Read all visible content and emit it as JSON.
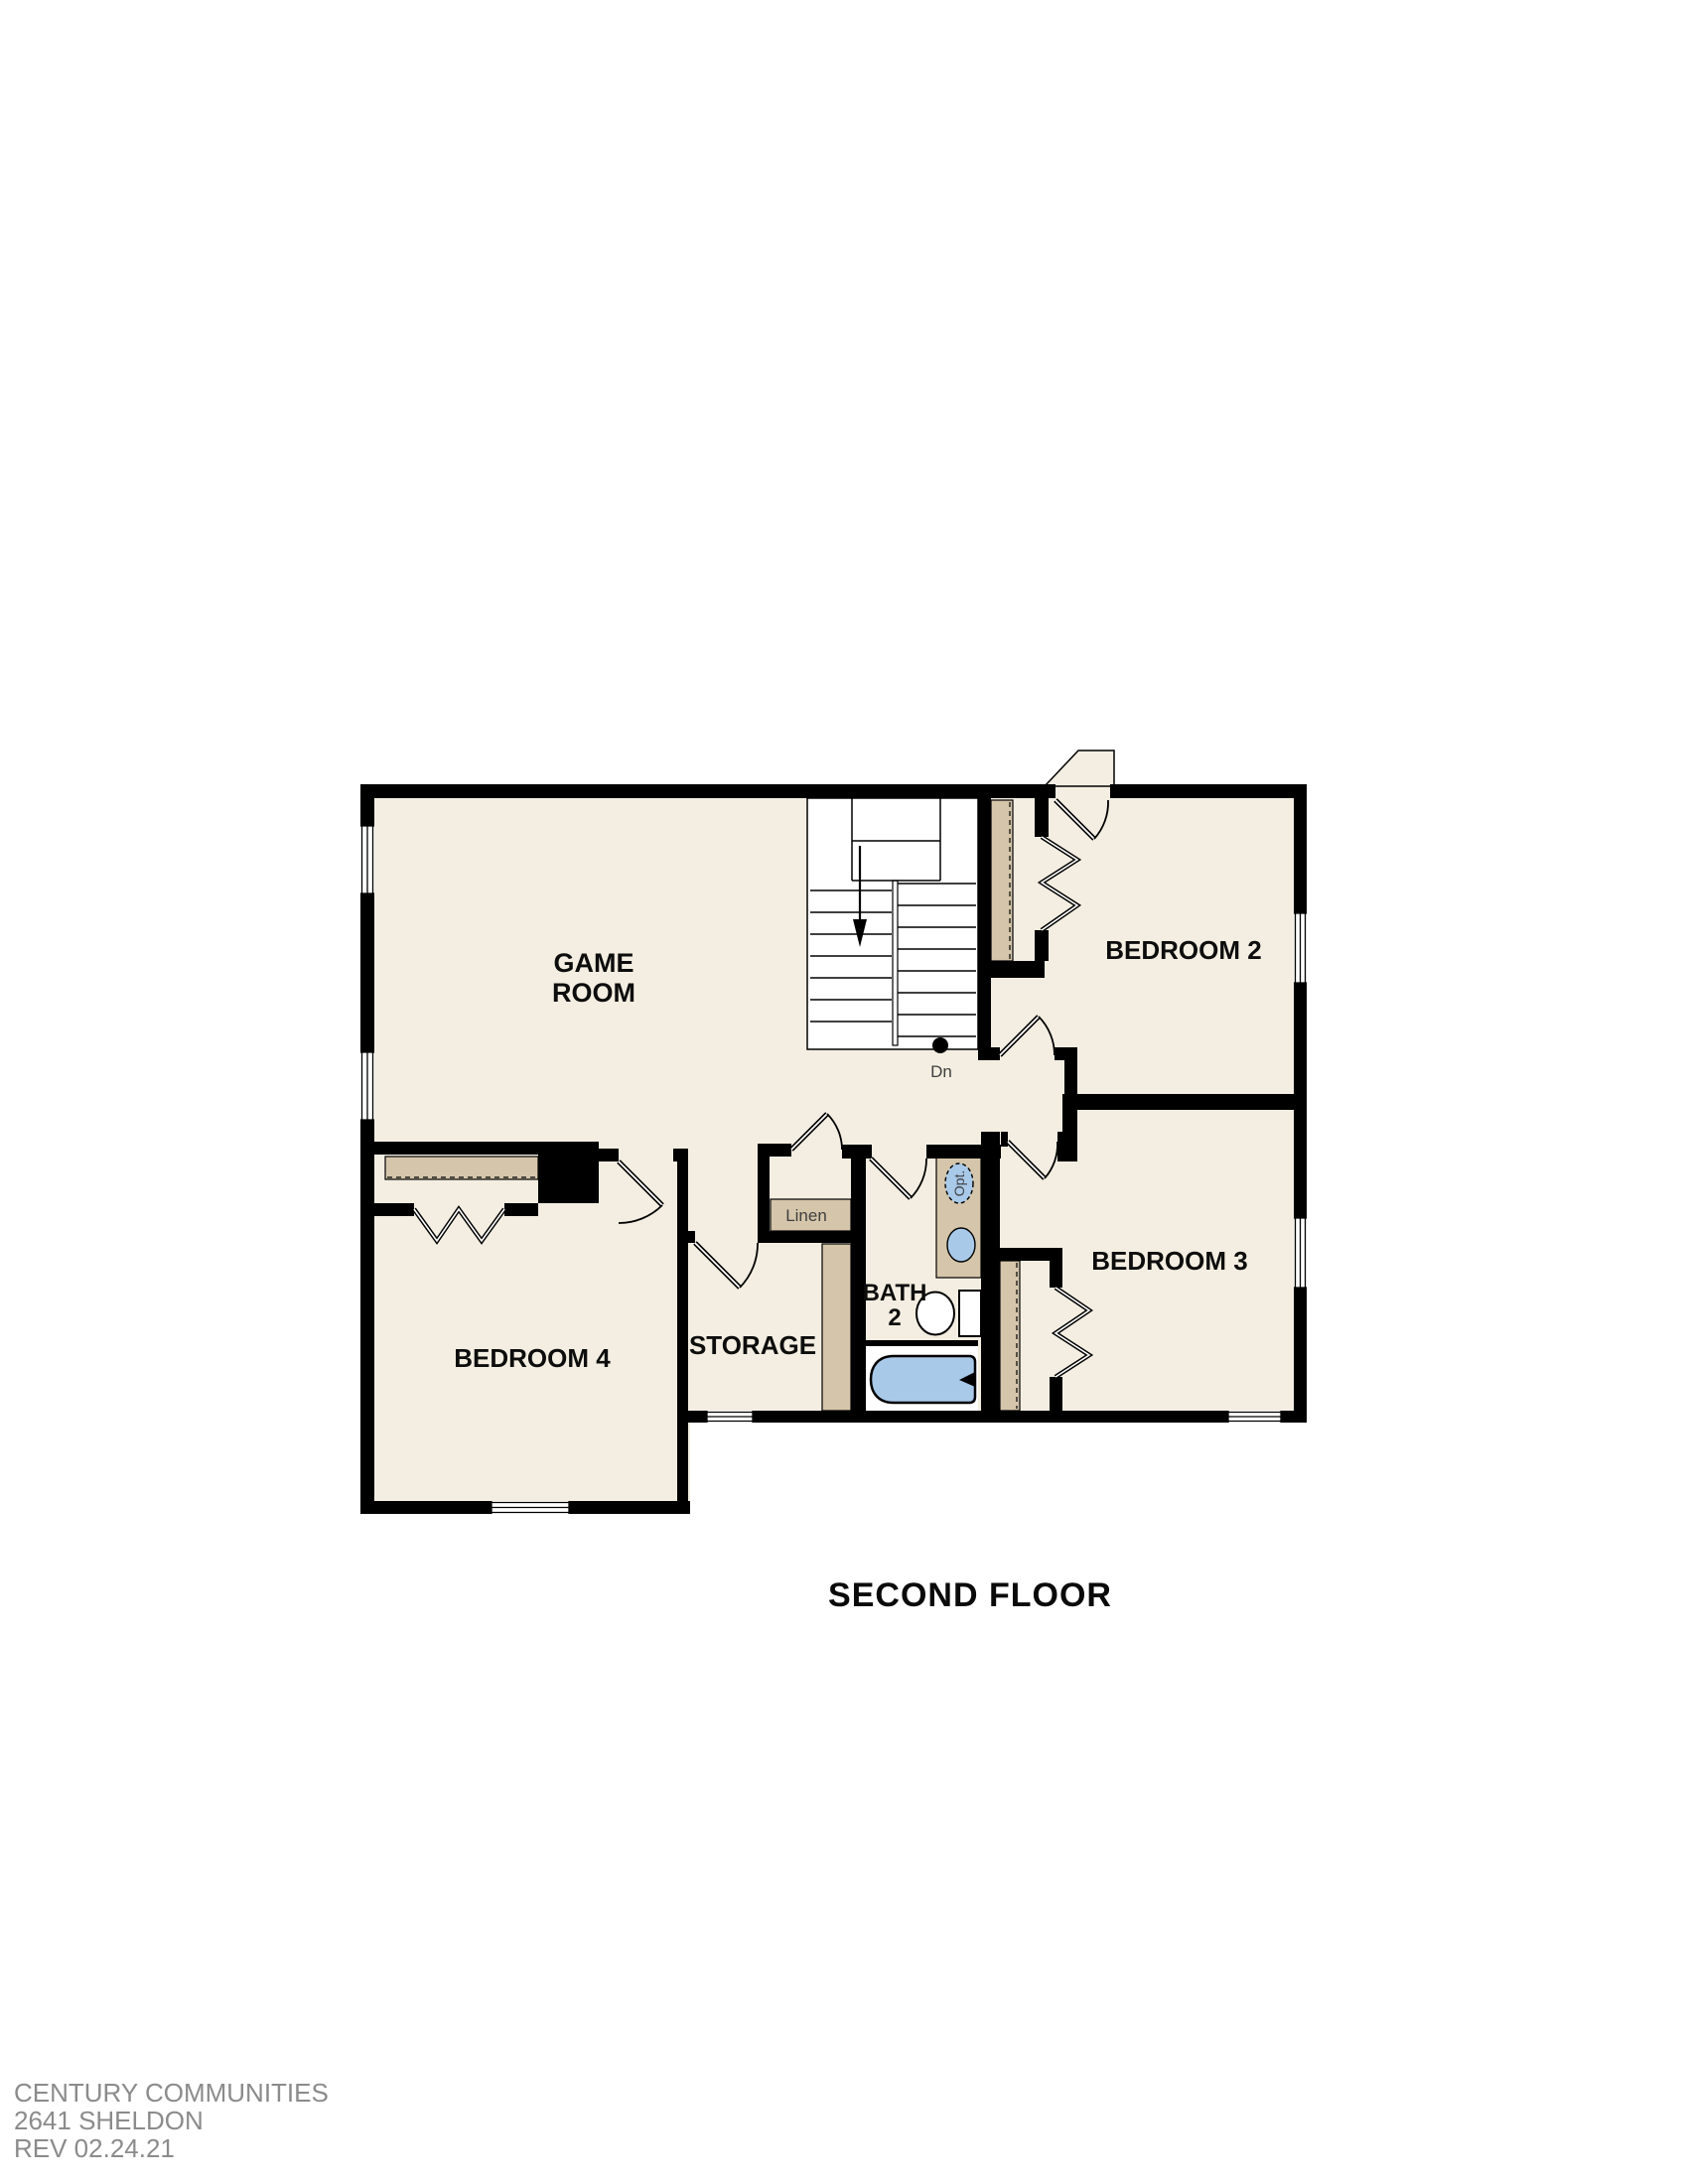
{
  "plan": {
    "title": "SECOND FLOOR",
    "rooms": {
      "game_room_line1": "GAME",
      "game_room_line2": "ROOM",
      "bedroom2": "BEDROOM 2",
      "bedroom3": "BEDROOM 3",
      "bedroom4": "BEDROOM 4",
      "storage": "STORAGE",
      "bath_line1": "BATH",
      "bath_line2": "2",
      "linen": "Linen"
    },
    "annotations": {
      "stair_direction": "Dn",
      "optional_fixture": "Opt."
    }
  },
  "footer": {
    "line1": "CENTURY COMMUNITIES",
    "line2": "2641 SHELDON",
    "line3": "REV 02.24.21"
  },
  "colors": {
    "wall": "#000000",
    "floor": "#f3eee1",
    "millwork_tan": "#d5c6ab",
    "fixture_blue": "#a9c9e9",
    "page_bg": "#ffffff",
    "footer_text": "#8b8b8b",
    "annotation_text": "#3f3f3f"
  }
}
